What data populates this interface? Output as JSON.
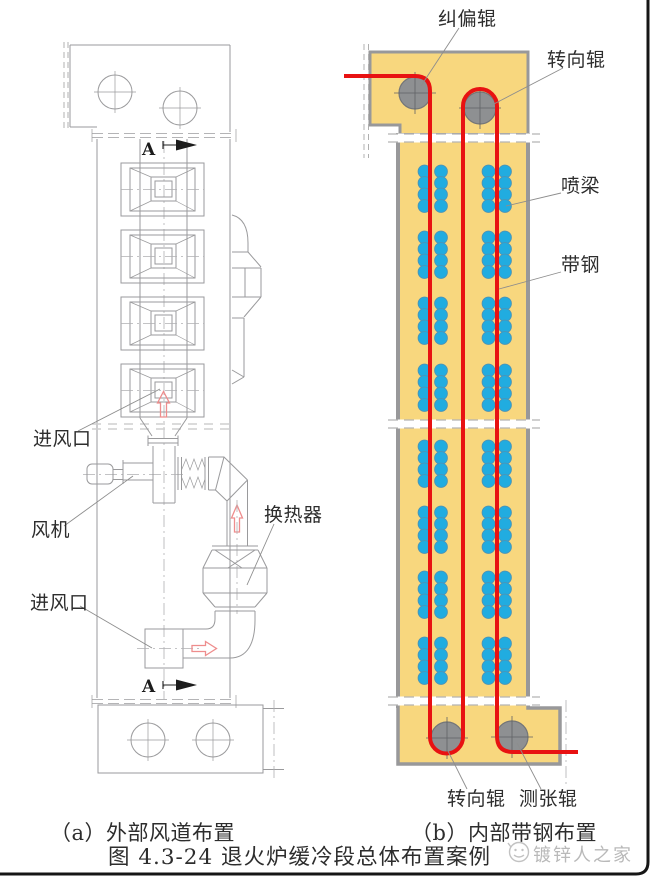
{
  "colors": {
    "furnace-yellow": "#f8d77e",
    "wall-gray": "#98989a",
    "strip-red": "#e81212",
    "dot-blue": "#21ace0",
    "dot-edge": "#4d93b5",
    "roller-gray": "#8e9092",
    "roller-edge": "#737578",
    "line-gray": "#9a9a9c",
    "arrow-pink": "#ee8d8d",
    "watermark-gray": "#b9b9b9",
    "border-black": "#161616"
  },
  "diagram_a": {
    "label_air_inlet_top": "进风口",
    "label_fan": "风机",
    "label_heat_exchanger": "换热器",
    "label_air_inlet_bottom": "进风口",
    "section_marker_top": "A",
    "section_marker_bottom": "A",
    "caption": "（a）外部风道布置"
  },
  "diagram_b": {
    "label_correction_roller": "纠偏辊",
    "label_turn_roller_top": "转向辊",
    "label_spray_beam": "喷梁",
    "label_strip_steel": "带钢",
    "label_turn_roller_bottom": "转向辊",
    "label_tension_roller": "测张辊",
    "caption": "（b）内部带钢布置"
  },
  "figure": {
    "title": "图 4.3-24  退火炉缓冷段总体布置案例",
    "watermark": "镀锌人之家"
  }
}
